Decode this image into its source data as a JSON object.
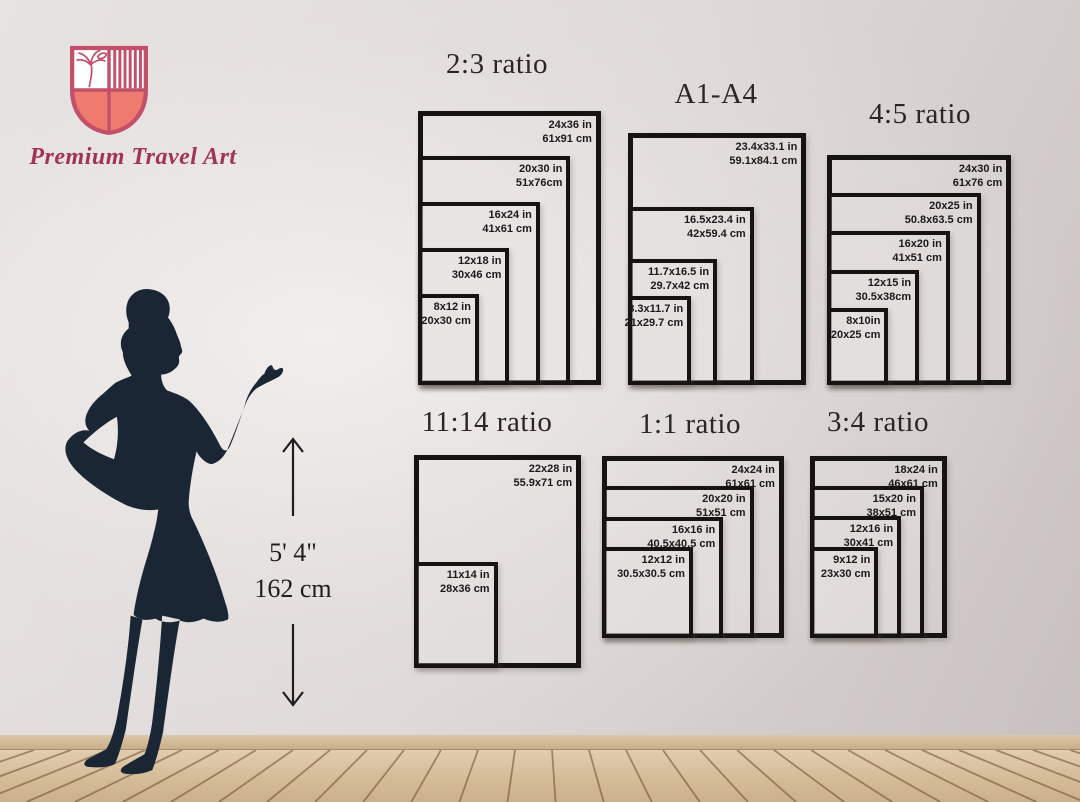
{
  "brand": {
    "name": "Premium Travel Art"
  },
  "height_indicator": {
    "imperial": "5' 4\"",
    "metric": "162 cm"
  },
  "groups": [
    {
      "title": "2:3 ratio",
      "sizes": [
        {
          "inches": "24x36 in",
          "cm": "61x91 cm",
          "w": 24,
          "h": 36
        },
        {
          "inches": "20x30 in",
          "cm": "51x76cm",
          "w": 20,
          "h": 30
        },
        {
          "inches": "16x24 in",
          "cm": "41x61 cm",
          "w": 16,
          "h": 24
        },
        {
          "inches": "12x18 in",
          "cm": "30x46 cm",
          "w": 12,
          "h": 18
        },
        {
          "inches": "8x12 in",
          "cm": "20x30 cm",
          "w": 8,
          "h": 12
        }
      ]
    },
    {
      "title": "A1-A4",
      "sizes": [
        {
          "inches": "23.4x33.1 in",
          "cm": "59.1x84.1 cm",
          "w": 23.4,
          "h": 33.1
        },
        {
          "inches": "16.5x23.4 in",
          "cm": "42x59.4 cm",
          "w": 16.5,
          "h": 23.4
        },
        {
          "inches": "11.7x16.5 in",
          "cm": "29.7x42 cm",
          "w": 11.7,
          "h": 16.5
        },
        {
          "inches": "8.3x11.7 in",
          "cm": "21x29.7 cm",
          "w": 8.3,
          "h": 11.7
        }
      ]
    },
    {
      "title": "4:5 ratio",
      "sizes": [
        {
          "inches": "24x30 in",
          "cm": "61x76 cm",
          "w": 24,
          "h": 30
        },
        {
          "inches": "20x25 in",
          "cm": "50.8x63.5 cm",
          "w": 20,
          "h": 25
        },
        {
          "inches": "16x20 in",
          "cm": "41x51 cm",
          "w": 16,
          "h": 20
        },
        {
          "inches": "12x15 in",
          "cm": "30.5x38cm",
          "w": 12,
          "h": 15
        },
        {
          "inches": "8x10in",
          "cm": "20x25 cm",
          "w": 8,
          "h": 10
        }
      ]
    },
    {
      "title": "11:14 ratio",
      "sizes": [
        {
          "inches": "22x28 in",
          "cm": "55.9x71 cm",
          "w": 22,
          "h": 28
        },
        {
          "inches": "11x14 in",
          "cm": "28x36 cm",
          "w": 11,
          "h": 14
        }
      ]
    },
    {
      "title": "1:1 ratio",
      "sizes": [
        {
          "inches": "24x24 in",
          "cm": "61x61 cm",
          "w": 24,
          "h": 24
        },
        {
          "inches": "20x20 in",
          "cm": "51x51 cm",
          "w": 20,
          "h": 20
        },
        {
          "inches": "16x16 in",
          "cm": "40.5x40.5 cm",
          "w": 16,
          "h": 16
        },
        {
          "inches": "12x12 in",
          "cm": "30.5x30.5 cm",
          "w": 12,
          "h": 12
        }
      ]
    },
    {
      "title": "3:4 ratio",
      "sizes": [
        {
          "inches": "18x24 in",
          "cm": "46x61 cm",
          "w": 18,
          "h": 24
        },
        {
          "inches": "15x20 in",
          "cm": "38x51 cm",
          "w": 15,
          "h": 20
        },
        {
          "inches": "12x16 in",
          "cm": "30x41 cm",
          "w": 12,
          "h": 16
        },
        {
          "inches": "9x12 in",
          "cm": "23x30 cm",
          "w": 9,
          "h": 12
        }
      ]
    }
  ],
  "colors": {
    "frame": "#161413",
    "silhouette": "#1b2634",
    "brand_rose": "#c2506a",
    "brand_salmon": "#ee7a70",
    "brand_text": "#a23354",
    "floor_wood": "#d7bf9c"
  }
}
